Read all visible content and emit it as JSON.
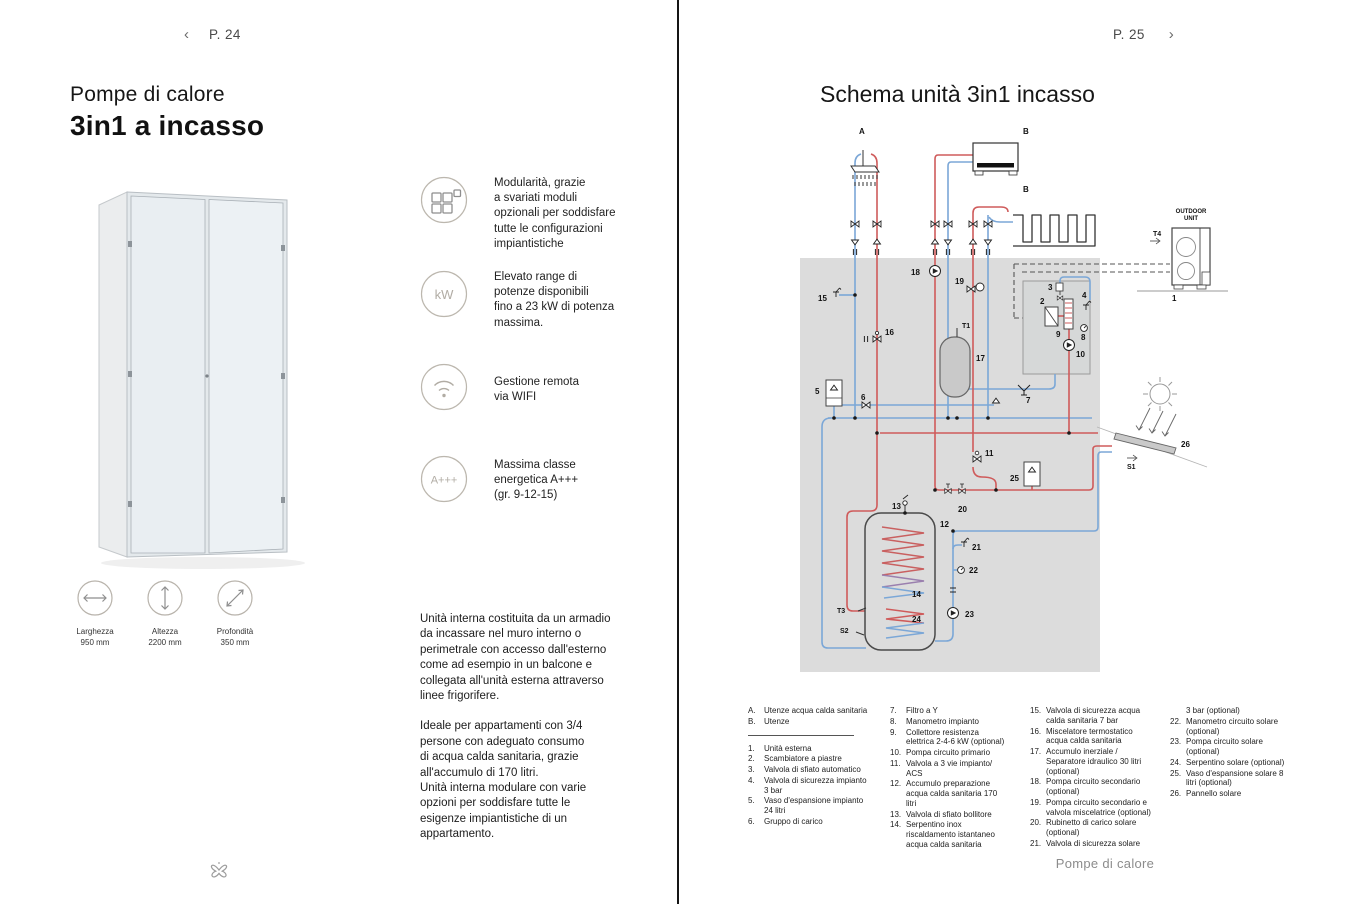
{
  "left_page": {
    "nav": {
      "back_chevron": "‹",
      "page_label": "P. 24"
    },
    "title_line1": "Pompe di calore",
    "title_line2": "3in1 a incasso",
    "features": [
      {
        "icon": "modules-icon",
        "text": "Modularità, grazie\na svariati moduli\nopzionali per soddisfare\ntutte le configurazioni\nimpiantistiche"
      },
      {
        "icon": "kw-icon",
        "icon_label": "kW",
        "text": "Elevato range di\npotenze disponibili\nfino a 23 kW di potenza\nmassima."
      },
      {
        "icon": "wifi-icon",
        "text": "Gestione remota\nvia WIFI"
      },
      {
        "icon": "energy-class-icon",
        "icon_label": "A+++",
        "text": "Massima classe\nenergetica A+++\n(gr. 9-12-15)"
      }
    ],
    "dimensions": [
      {
        "label": "Larghezza",
        "value": "950 mm"
      },
      {
        "label": "Altezza",
        "value": "2200 mm"
      },
      {
        "label": "Profondità",
        "value": "350 mm"
      }
    ],
    "body_paragraphs": [
      "Unità interna costituita da un armadio\nda incassare nel muro interno o\nperimetrale con accesso dall'esterno\ncome ad esempio in un balcone e\ncollegata all'unità esterna attraverso\nlinee frigorifere.",
      "Ideale per appartamenti con 3/4\npersone con adeguato consumo\ndi acqua calda sanitaria, grazie\nall'accumulo di 170 litri.\nUnità interna modulare con varie\nopzioni per soddisfare tutte le\nesigenze impiantistiche di un\nappartamento."
    ]
  },
  "right_page": {
    "nav": {
      "page_label": "P. 25",
      "next_chevron": "›"
    },
    "title": "Schema unità 3in1 incasso",
    "footer": "Pompe di calore",
    "legend": {
      "columns": [
        {
          "divider_after": 1,
          "items": [
            {
              "n": "A.",
              "t": "Utenze acqua calda sanitaria"
            },
            {
              "n": "B.",
              "t": "Utenze"
            },
            {
              "n": "1.",
              "t": "Unità esterna"
            },
            {
              "n": "2.",
              "t": "Scambiatore a piastre"
            },
            {
              "n": "3.",
              "t": "Valvola di sfiato automatico"
            },
            {
              "n": "4.",
              "t": "Valvola di sicurezza impianto 3 bar"
            },
            {
              "n": "5.",
              "t": "Vaso d'espansione impianto 24 litri"
            },
            {
              "n": "6.",
              "t": "Gruppo di carico"
            }
          ]
        },
        {
          "items": [
            {
              "n": "7.",
              "t": "Filtro a Y"
            },
            {
              "n": "8.",
              "t": "Manometro impianto"
            },
            {
              "n": "9.",
              "t": "Collettore resistenza elettrica 2-4-6 kW (optional)"
            },
            {
              "n": "10.",
              "t": "Pompa circuito primario"
            },
            {
              "n": "11.",
              "t": "Valvola a 3 vie impianto/ ACS"
            },
            {
              "n": "12.",
              "t": "Accumulo preparazione acqua calda sanitaria 170 litri"
            },
            {
              "n": "13.",
              "t": "Valvola di sfiato bollitore"
            },
            {
              "n": "14.",
              "t": "Serpentino inox riscaldamento istantaneo acqua calda sanitaria"
            }
          ]
        },
        {
          "items": [
            {
              "n": "15.",
              "t": "Valvola di sicurezza acqua calda sanitaria 7 bar"
            },
            {
              "n": "16.",
              "t": "Miscelatore termostatico acqua calda sanitaria"
            },
            {
              "n": "17.",
              "t": "Accumulo inerziale / Separatore idraulico 30 litri (optional)"
            },
            {
              "n": "18.",
              "t": "Pompa circuito secondario (optional)"
            },
            {
              "n": "19.",
              "t": "Pompa circuito secondario e valvola miscelatrice (optional)"
            },
            {
              "n": "20.",
              "t": "Rubinetto di carico solare (optional)"
            },
            {
              "n": "21.",
              "t": "Valvola di sicurezza solare"
            }
          ]
        },
        {
          "items": [
            {
              "n": "",
              "t": "3 bar (optional)"
            },
            {
              "n": "22.",
              "t": "Manometro circuito solare (optional)"
            },
            {
              "n": "23.",
              "t": "Pompa circuito solare (optional)"
            },
            {
              "n": "24.",
              "t": "Serpentino solare (optional)"
            },
            {
              "n": "25.",
              "t": "Vaso d'espansione solare 8 litri (optional)"
            },
            {
              "n": "26.",
              "t": "Pannello solare"
            }
          ]
        }
      ]
    },
    "diagram": {
      "colors": {
        "hot_pipe": "#cf5b5b",
        "cold_pipe": "#7ba7d7",
        "unit_box": "#dcdcdc"
      },
      "labels": [
        {
          "t": "A",
          "x": 859,
          "y": 134
        },
        {
          "t": "B",
          "x": 1023,
          "y": 134
        },
        {
          "t": "B",
          "x": 1023,
          "y": 192
        },
        {
          "t": "18",
          "x": 911,
          "y": 275
        },
        {
          "t": "19",
          "x": 955,
          "y": 284
        },
        {
          "t": "15",
          "x": 818,
          "y": 301
        },
        {
          "t": "16",
          "x": 885,
          "y": 335
        },
        {
          "t": "T1",
          "x": 962,
          "y": 328,
          "s": 7
        },
        {
          "t": "17",
          "x": 976,
          "y": 361
        },
        {
          "t": "2",
          "x": 1040,
          "y": 304
        },
        {
          "t": "3",
          "x": 1048,
          "y": 290
        },
        {
          "t": "4",
          "x": 1082,
          "y": 298
        },
        {
          "t": "9",
          "x": 1056,
          "y": 337
        },
        {
          "t": "8",
          "x": 1081,
          "y": 340
        },
        {
          "t": "10",
          "x": 1076,
          "y": 357
        },
        {
          "t": "7",
          "x": 1026,
          "y": 403
        },
        {
          "t": "5",
          "x": 815,
          "y": 394
        },
        {
          "t": "6",
          "x": 861,
          "y": 400
        },
        {
          "t": "11",
          "x": 985,
          "y": 456
        },
        {
          "t": "25",
          "x": 1010,
          "y": 481
        },
        {
          "t": "20",
          "x": 958,
          "y": 512
        },
        {
          "t": "13",
          "x": 892,
          "y": 509
        },
        {
          "t": "12",
          "x": 940,
          "y": 527
        },
        {
          "t": "21",
          "x": 972,
          "y": 550
        },
        {
          "t": "22",
          "x": 969,
          "y": 573
        },
        {
          "t": "23",
          "x": 965,
          "y": 617
        },
        {
          "t": "14",
          "x": 912,
          "y": 597
        },
        {
          "t": "24",
          "x": 912,
          "y": 622
        },
        {
          "t": "T3",
          "x": 837,
          "y": 613,
          "s": 7
        },
        {
          "t": "S2",
          "x": 840,
          "y": 633,
          "s": 7
        },
        {
          "t": "26",
          "x": 1181,
          "y": 447
        },
        {
          "t": "S1",
          "x": 1127,
          "y": 469,
          "s": 7
        },
        {
          "t": "T4",
          "x": 1153,
          "y": 236,
          "s": 7
        },
        {
          "t": "1",
          "x": 1172,
          "y": 301
        },
        {
          "t": "OUTDOOR",
          "x": 1191,
          "y": 213,
          "s": 6,
          "n": 1,
          "a": "m"
        },
        {
          "t": "UNIT",
          "x": 1191,
          "y": 220,
          "s": 6,
          "n": 1,
          "a": "m"
        }
      ]
    }
  }
}
